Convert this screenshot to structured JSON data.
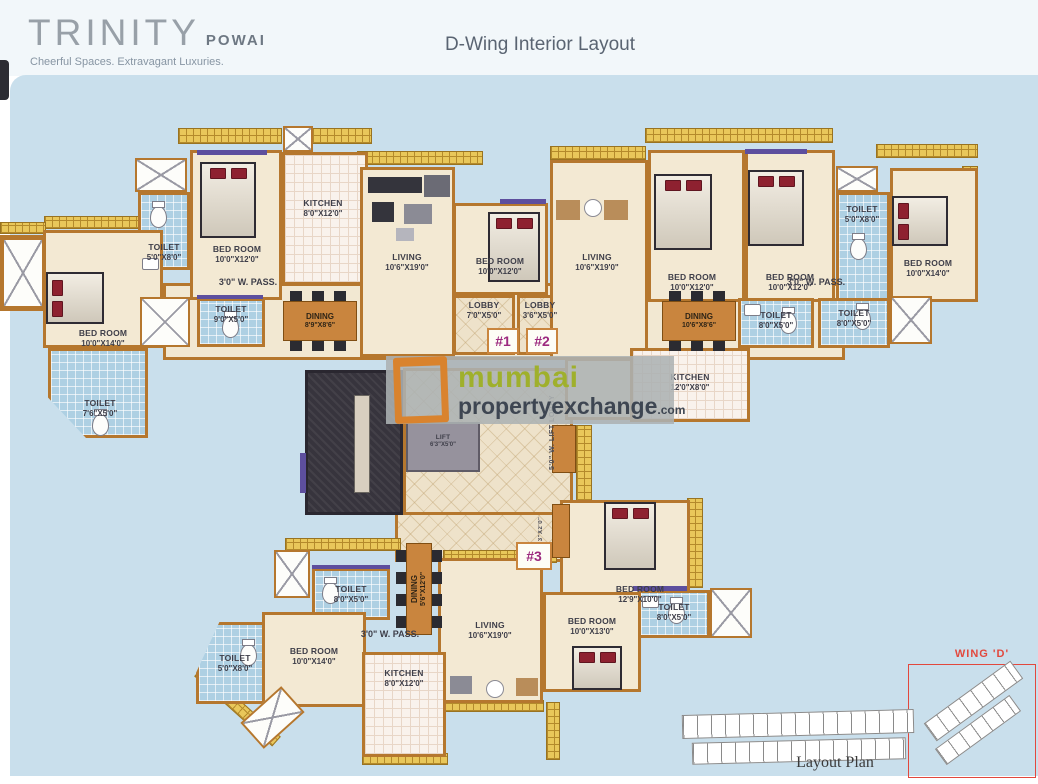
{
  "header": {
    "brand": "TRINITY",
    "brand_sub": "POWAI",
    "tagline": "Cheerful Spaces. Extravagant Luxuries.",
    "title": "D-Wing Interior Layout"
  },
  "watermark": {
    "word1": "mumbai",
    "word2": "propertyexchange",
    "word3": ".com"
  },
  "units": {
    "u1": "#1",
    "u2": "#2",
    "u3": "#3"
  },
  "labels": {
    "pass": "3'0\" W. PASS.",
    "lift_lobby": "5'0\" W. LIFT LOBBY",
    "niche": "6'3\"X2'0\""
  },
  "rooms": [
    {
      "name": "TOILET",
      "dim": "5'0\"X8'0\""
    },
    {
      "name": "BED ROOM",
      "dim": "10'0\"X12'0\""
    },
    {
      "name": "KITCHEN",
      "dim": "8'0\"X12'0\""
    },
    {
      "name": "LIVING",
      "dim": "10'6\"X19'0\""
    },
    {
      "name": "BED ROOM",
      "dim": "10'0\"X14'0\""
    },
    {
      "name": "TOILET",
      "dim": "9'0\"X5'0\""
    },
    {
      "name": "TOILET",
      "dim": "7'6\"X5'0\""
    },
    {
      "name": "DINING",
      "dim": "8'9\"X8'6\""
    },
    {
      "name": "BED ROOM",
      "dim": "10'0\"X12'0\""
    },
    {
      "name": "LOBBY",
      "dim": "7'0\"X5'0\""
    },
    {
      "name": "LOBBY",
      "dim": "3'6\"X5'0\""
    },
    {
      "name": "LIVING",
      "dim": "10'6\"X19'0\""
    },
    {
      "name": "BED ROOM",
      "dim": "10'0\"X12'0\""
    },
    {
      "name": "BED ROOM",
      "dim": "10'0\"X12'0\""
    },
    {
      "name": "TOILET",
      "dim": "5'0\"X8'0\""
    },
    {
      "name": "BED ROOM",
      "dim": "10'0\"X14'0\""
    },
    {
      "name": "DINING",
      "dim": "10'6\"X8'6\""
    },
    {
      "name": "TOILET",
      "dim": "8'0\"X5'0\""
    },
    {
      "name": "TOILET",
      "dim": "8'0\"X5'0\""
    },
    {
      "name": "KITCHEN",
      "dim": "12'0\"X8'0\""
    },
    {
      "name": "LIFT",
      "dim": "6'3\"X5'0\""
    },
    {
      "name": "BED ROOM",
      "dim": "12'9\"X10'0\""
    },
    {
      "name": "TOILET",
      "dim": "8'0\"X5'0\""
    },
    {
      "name": "BED ROOM",
      "dim": "10'0\"X13'0\""
    },
    {
      "name": "TOILET",
      "dim": "8'0\"X5'0\""
    },
    {
      "name": "DINING",
      "dim": "5'6\"X12'0\""
    },
    {
      "name": "LIVING",
      "dim": "10'6\"X19'0\""
    },
    {
      "name": "TOILET",
      "dim": "5'0\"X8'0\""
    },
    {
      "name": "BED ROOM",
      "dim": "10'0\"X14'0\""
    },
    {
      "name": "KITCHEN",
      "dim": "8'0\"X12'0\""
    }
  ],
  "footer": {
    "layout_plan": "Layout Plan",
    "wing": "WING 'D'"
  }
}
